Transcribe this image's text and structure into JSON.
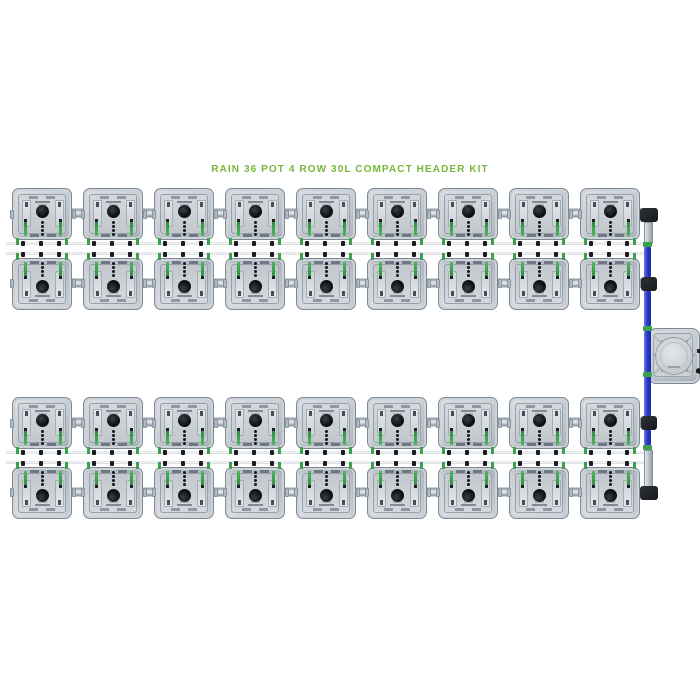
{
  "product_title": "RAIN 36 POT 4 ROW 30L COMPACT HEADER KIT",
  "diagram": {
    "total_pots": 36,
    "rows": [
      {
        "label": "row-1",
        "pots": 9,
        "orientation": "normal"
      },
      {
        "label": "row-2",
        "pots": 9,
        "orientation": "flipped"
      },
      {
        "label": "row-3",
        "pots": 9,
        "orientation": "normal"
      },
      {
        "label": "row-4",
        "pots": 9,
        "orientation": "flipped"
      }
    ],
    "header": {
      "tank": "compact-header-tank",
      "feed_pipe": "vertical-header-pipe",
      "fittings": [
        "elbow-top",
        "tee-row-2",
        "tee-row-3",
        "elbow-bottom"
      ],
      "couplers": 4
    }
  },
  "colors": {
    "title_green": "#77b83a",
    "header_pipe_blue": "#2c3bcd",
    "coupler_green": "#3aa24d",
    "fitting_black": "#17191d",
    "pot_body_gray": "#c8cdd3",
    "pipe_gray": "#c3c9ce",
    "background": "#ffffff"
  }
}
